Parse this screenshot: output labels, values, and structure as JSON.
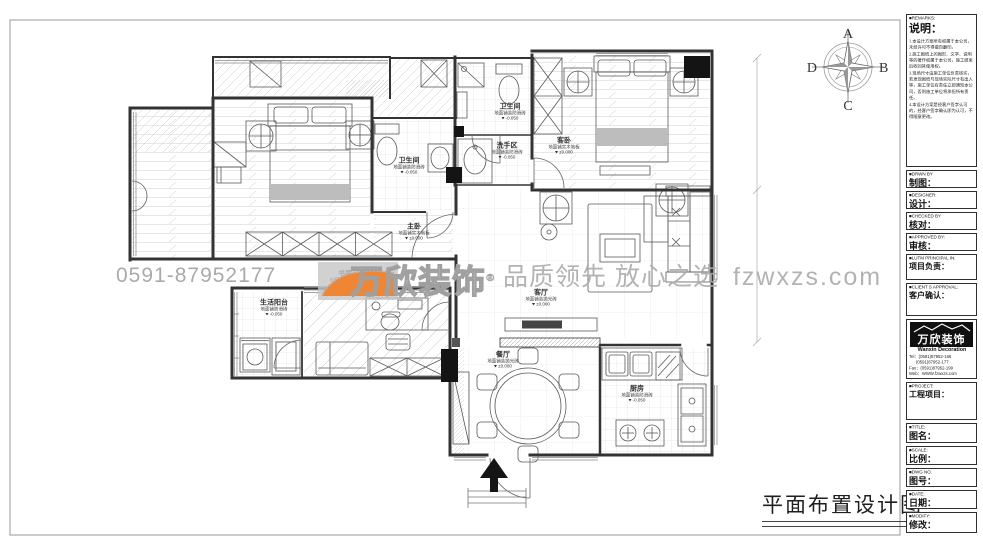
{
  "watermark": {
    "phone": "0591-87952177",
    "brand": "万欣装饰",
    "registered_mark": "®",
    "slogan": "品质领先 放心之选",
    "website": "fzwxzs.com",
    "orange": "#ee8636",
    "gray": "#ababab"
  },
  "plan_title": "平面布置设计图",
  "compass": {
    "top": "A",
    "right": "B",
    "bottom": "C",
    "left": "D"
  },
  "rooms": [
    {
      "name": "主卧",
      "floor": "地面铺实木地板",
      "level": "±0.000"
    },
    {
      "name": "卫生间",
      "floor": "地面铺装防滑砖",
      "level": "-0.050"
    },
    {
      "name": "卫生间",
      "floor": "地面铺装防滑砖",
      "level": "-0.050"
    },
    {
      "name": "洗手区",
      "floor": "地面铺装防滑砖",
      "level": "-0.050"
    },
    {
      "name": "客卧",
      "floor": "地面铺实木地板",
      "level": "±0.000"
    },
    {
      "name": "客厅",
      "floor": "地面铺装抛光砖",
      "level": "±0.000"
    },
    {
      "name": "餐厅",
      "floor": "地面铺装抛光砖",
      "level": "±0.000"
    },
    {
      "name": "厨房",
      "floor": "地面铺装防滑砖",
      "level": "-0.050"
    },
    {
      "name": "书房",
      "floor": "地面铺实木地板",
      "level": "±0.000"
    },
    {
      "name": "生活阳台",
      "floor": "地面铺防滑砖",
      "level": "-0.050"
    }
  ],
  "title_block": {
    "remarks_header": "■REMARKS:",
    "remarks_label": "说明：",
    "remarks": [
      "1.本设计方案所有权属于本公司，未经许可不得擅自翻印。",
      "2.施工图纸上的图形、文字、说明等的著作权属于本公司，施工结束后收回其使用权。",
      "3.现场尺寸由施工单位负责核实，若发现图纸与现场实际尺寸有出入等，施工单位有责任立即通知本公司，否则施工单位将承担所有责任。",
      "4.本设计方案是经客户签字认可的，经客户签字确认即为认可，不得随意更改。"
    ],
    "fields": [
      {
        "header": "■DRWN BY",
        "label": "制图："
      },
      {
        "header": "■DESIGNER:",
        "label": "设计："
      },
      {
        "header": "■CHECKED BY",
        "label": "核对："
      },
      {
        "header": "■APPROVED BY:",
        "label": "审核："
      },
      {
        "header": "■LUTM PRINCIPAL IN:",
        "label": "项目负责："
      },
      {
        "header": "■CLIENT S APPROVAL:",
        "label": "客户确认："
      },
      {
        "header": "■PROJECT:",
        "label": "工程项目："
      },
      {
        "header": "■TITLE:",
        "label": "图名："
      },
      {
        "header": "■SCALE:",
        "label": "比例："
      },
      {
        "header": "■DWG NO.",
        "label": "图号："
      },
      {
        "header": "■DATE:",
        "label": "日期："
      },
      {
        "header": "■MODIFY:",
        "label": "修改："
      }
    ],
    "company": {
      "logo_cn": "万欣装饰",
      "logo_en": "Wanxin Decoration",
      "tel1": "Tel：(0591)87952-166",
      "tel2": "(0591)87952-177",
      "fax": "Fax：(0591)87952-199",
      "web": "Web：WWW.fzwxzs.com"
    }
  }
}
